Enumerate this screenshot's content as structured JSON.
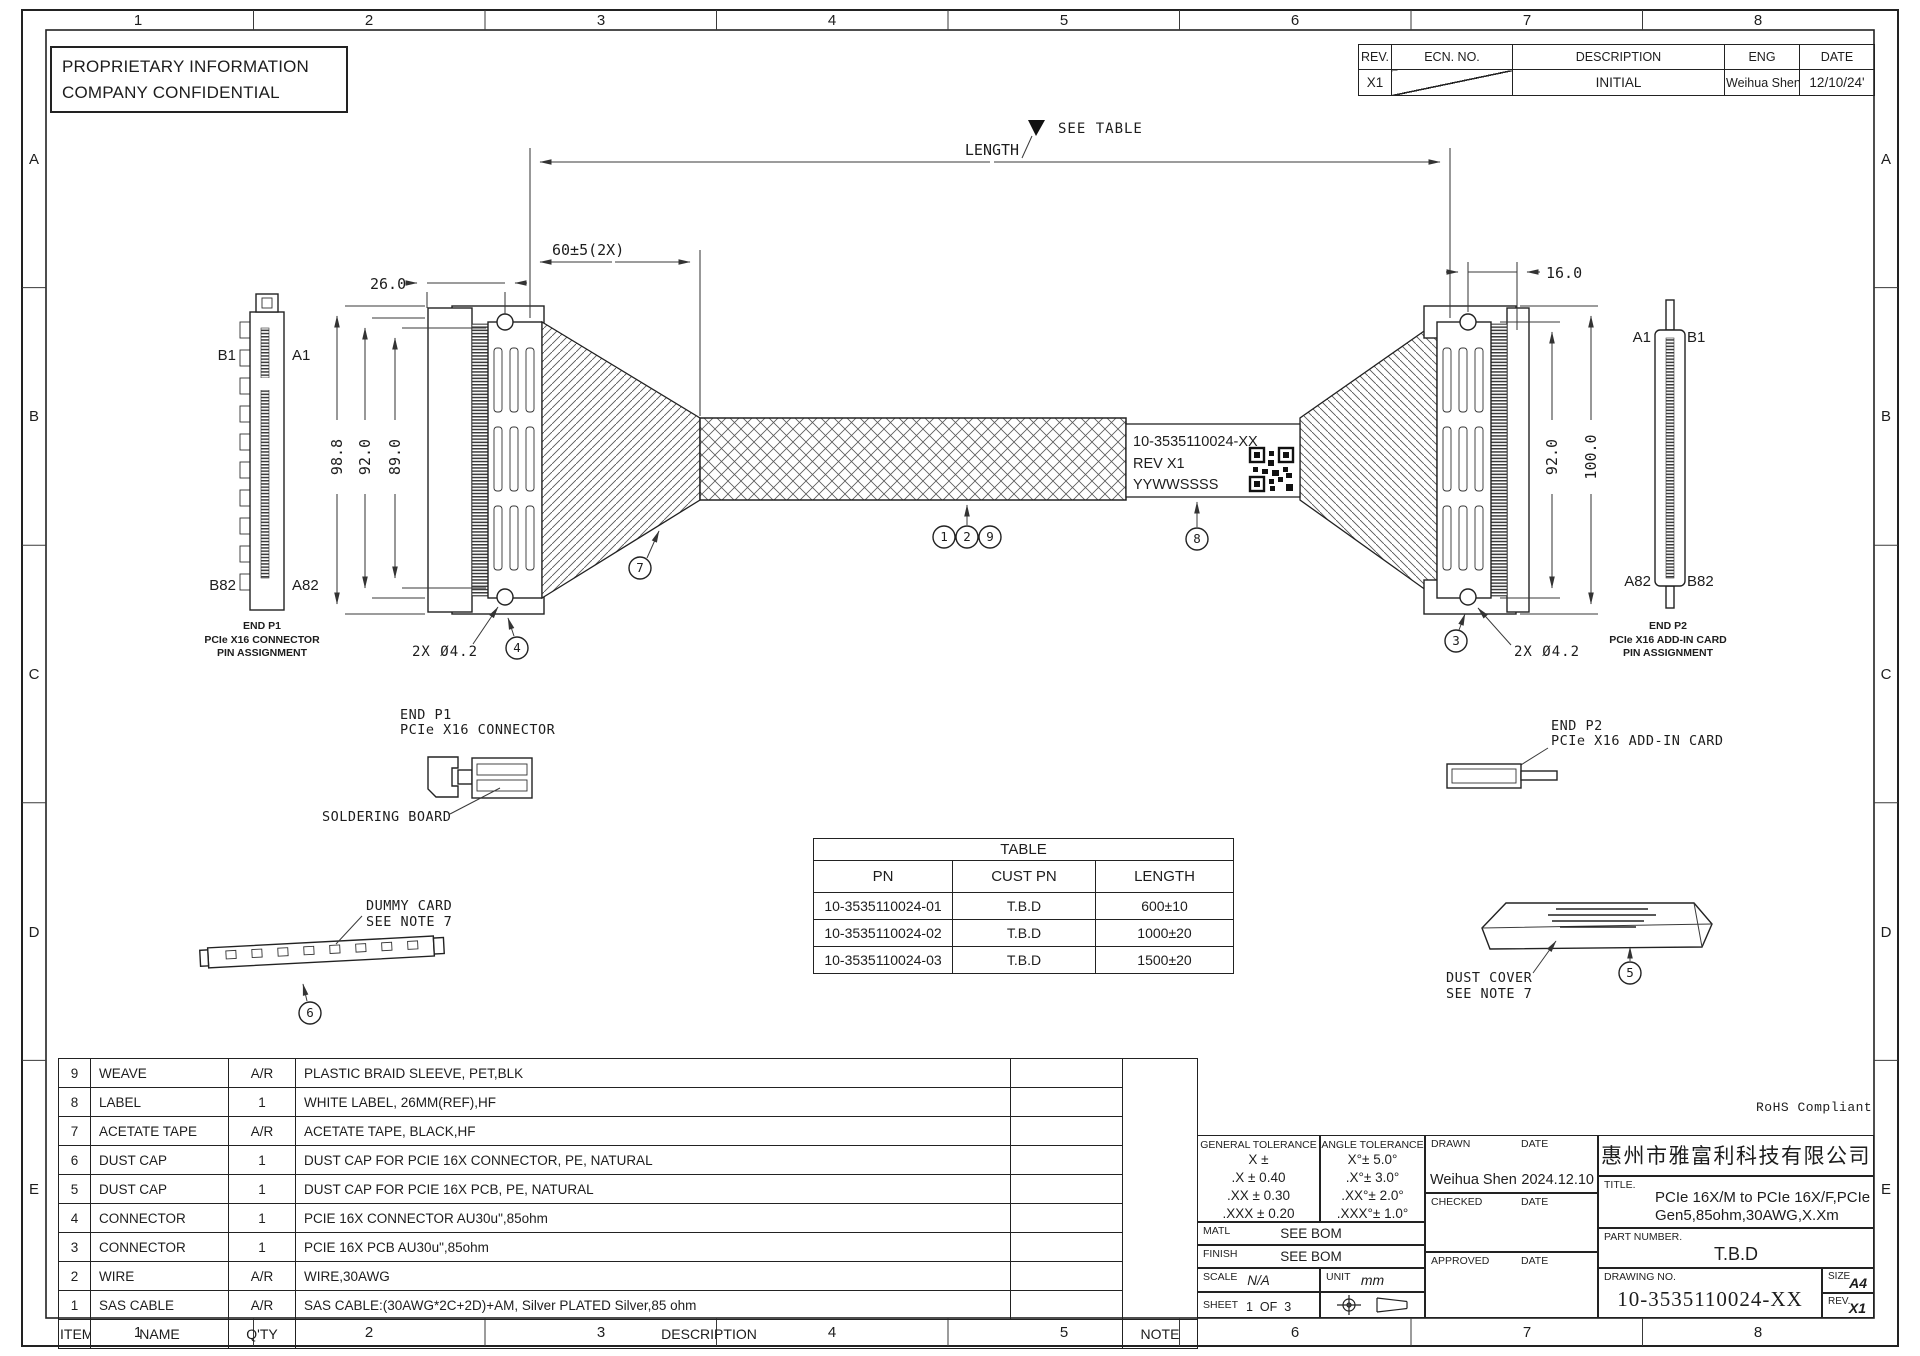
{
  "page": {
    "background": "#ffffff",
    "line_color": "#222222"
  },
  "header": {
    "proprietary_line1": "PROPRIETARY INFORMATION",
    "proprietary_line2": "COMPANY CONFIDENTIAL",
    "rohs": "RoHS Compliant"
  },
  "zones": {
    "cols": [
      "1",
      "2",
      "3",
      "4",
      "5",
      "6",
      "7",
      "8"
    ],
    "rows": [
      "A",
      "B",
      "C",
      "D",
      "E"
    ]
  },
  "revision_table": {
    "headers": {
      "rev": "REV.",
      "ecn": "ECN. NO.",
      "description": "DESCRIPTION",
      "eng": "ENG",
      "date": "DATE"
    },
    "entry": {
      "rev": "X1",
      "ecn": "",
      "description": "INITIAL",
      "eng": "Weihua Shen",
      "date": "12/10/24'"
    }
  },
  "drawing": {
    "see_table": "SEE TABLE",
    "length": "LENGTH",
    "dim_60": "60±5(2X)",
    "dim_26": "26.0",
    "dim_16": "16.0",
    "dim_98_8": "98.8",
    "dim_92_left": "92.0",
    "dim_89": "89.0",
    "dim_92_right": "92.0",
    "dim_100": "100.0",
    "hole_left": "2X Ø4.2",
    "hole_right": "2X Ø4.2",
    "label_line1": "10-3535110024-XX",
    "label_line2": "REV X1",
    "label_line3": "YYWWSSSS",
    "p1_pins": {
      "b1": "B1",
      "a1": "A1",
      "b82": "B82",
      "a82": "A82"
    },
    "p2_pins": {
      "a1": "A1",
      "b1": "B1",
      "a82": "A82",
      "b82": "B82"
    },
    "p1_caption": [
      "END P1",
      "PCIe X16 CONNECTOR",
      "PIN ASSIGNMENT"
    ],
    "p2_caption": [
      "END P2",
      "PCIe X16 ADD-IN CARD",
      "PIN ASSIGNMENT"
    ],
    "p1_callout": [
      "END P1",
      "PCIe X16 CONNECTOR"
    ],
    "p2_callout": [
      "END P2",
      "PCIe X16 ADD-IN CARD"
    ],
    "soldering_board": "SOLDERING BOARD",
    "dummy_card": [
      "DUMMY CARD",
      "SEE NOTE 7"
    ],
    "dust_cover": [
      "DUST COVER",
      "SEE NOTE 7"
    ],
    "balloons": {
      "n1": "1",
      "n2": "2",
      "n9": "9",
      "n8": "8",
      "n7": "7",
      "n4": "4",
      "n3": "3",
      "n6": "6",
      "n5": "5"
    }
  },
  "table": {
    "title": "TABLE",
    "headers": [
      "PN",
      "CUST PN",
      "LENGTH"
    ],
    "rows": [
      {
        "pn": "10-3535110024-01",
        "cust_pn": "T.B.D",
        "length": "600±10"
      },
      {
        "pn": "10-3535110024-02",
        "cust_pn": "T.B.D",
        "length": "1000±20"
      },
      {
        "pn": "10-3535110024-03",
        "cust_pn": "T.B.D",
        "length": "1500±20"
      }
    ]
  },
  "bom": {
    "rows": [
      {
        "item": "9",
        "name": "WEAVE",
        "qty": "A/R",
        "desc": "PLASTIC BRAID SLEEVE, PET,BLK"
      },
      {
        "item": "8",
        "name": "LABEL",
        "qty": "1",
        "desc": "WHITE LABEL, 26MM(REF),HF"
      },
      {
        "item": "7",
        "name": "ACETATE TAPE",
        "qty": "A/R",
        "desc": "ACETATE TAPE, BLACK,HF"
      },
      {
        "item": "6",
        "name": "DUST CAP",
        "qty": "1",
        "desc": "DUST CAP FOR PCIE 16X CONNECTOR, PE, NATURAL"
      },
      {
        "item": "5",
        "name": "DUST CAP",
        "qty": "1",
        "desc": "DUST CAP FOR PCIE 16X PCB, PE, NATURAL"
      },
      {
        "item": "4",
        "name": "CONNECTOR",
        "qty": "1",
        "desc": "PCIE 16X CONNECTOR AU30u\",85ohm"
      },
      {
        "item": "3",
        "name": "CONNECTOR",
        "qty": "1",
        "desc": "PCIE 16X PCB AU30u\",85ohm"
      },
      {
        "item": "2",
        "name": "WIRE",
        "qty": "A/R",
        "desc": "WIRE,30AWG"
      },
      {
        "item": "1",
        "name": "SAS CABLE",
        "qty": "A/R",
        "desc": "SAS CABLE:(30AWG*2C+2D)+AM, Silver PLATED Silver,85 ohm"
      }
    ],
    "footer": {
      "item": "ITEM",
      "name": "NAME",
      "qty": "Q'TY",
      "desc": "DESCRIPTION",
      "note": "NOTE"
    }
  },
  "title_block": {
    "general_tolerance": {
      "title": "GENERAL TOLERANCE",
      "lines": [
        "X ±",
        ".X ± 0.40",
        ".XX ± 0.30",
        ".XXX ± 0.20"
      ]
    },
    "angle_tolerance": {
      "title": "ANGLE TOLERANCE",
      "lines": [
        "X°± 5.0°",
        ".X°± 3.0°",
        ".XX°± 2.0°",
        ".XXX°± 1.0°"
      ]
    },
    "matl_label": "MATL",
    "matl_value": "SEE BOM",
    "finish_label": "FINISH",
    "finish_value": "SEE BOM",
    "scale_label": "SCALE",
    "scale_value": "N/A",
    "unit_label": "UNIT",
    "unit_value": "mm",
    "sheet_label": "SHEET",
    "sheet_value": "1  OF  3",
    "drawn_label": "DRAWN",
    "checked_label": "CHECKED",
    "approved_label": "APPROVED",
    "date_label": "DATE",
    "drawn_name": "Weihua Shen",
    "drawn_date": "2024.12.10",
    "company": "惠州市雅富利科技有限公司",
    "title_label": "TITLE.",
    "title_line1": "PCIe 16X/M to PCIe 16X/F,PCIe",
    "title_line2": "Gen5,85ohm,30AWG,X.Xm",
    "part_number_label": "PART NUMBER.",
    "part_number": "T.B.D",
    "drawing_no_label": "DRAWING NO.",
    "drawing_no": "10-3535110024-XX",
    "size_label": "SIZE",
    "size_value": "A4",
    "rev_label": "REV.",
    "rev_value": "X1"
  }
}
